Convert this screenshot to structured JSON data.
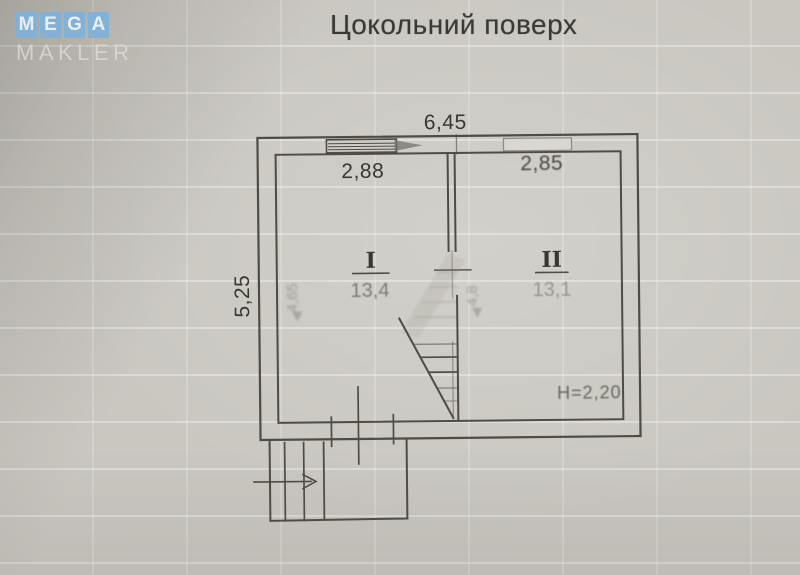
{
  "watermark": {
    "tiles": [
      "M",
      "E",
      "G",
      "A"
    ],
    "subtitle": "MAKLER"
  },
  "title": "Цокольний поверх",
  "plan": {
    "overall_width": "6,45",
    "room1_width": "2,88",
    "room2_width": "2,85",
    "overall_height": "5,25",
    "height_note": "H=2,20",
    "room1": {
      "numeral": "I",
      "area": "13,4"
    },
    "room2": {
      "numeral": "II",
      "area": "13,1"
    },
    "faded_marks": {
      "left": "4,65",
      "middle": "4,8"
    }
  },
  "colors": {
    "logo_tile": "#7fb2d9",
    "paper": "#c9c7c0",
    "line": "#4e4c45"
  }
}
